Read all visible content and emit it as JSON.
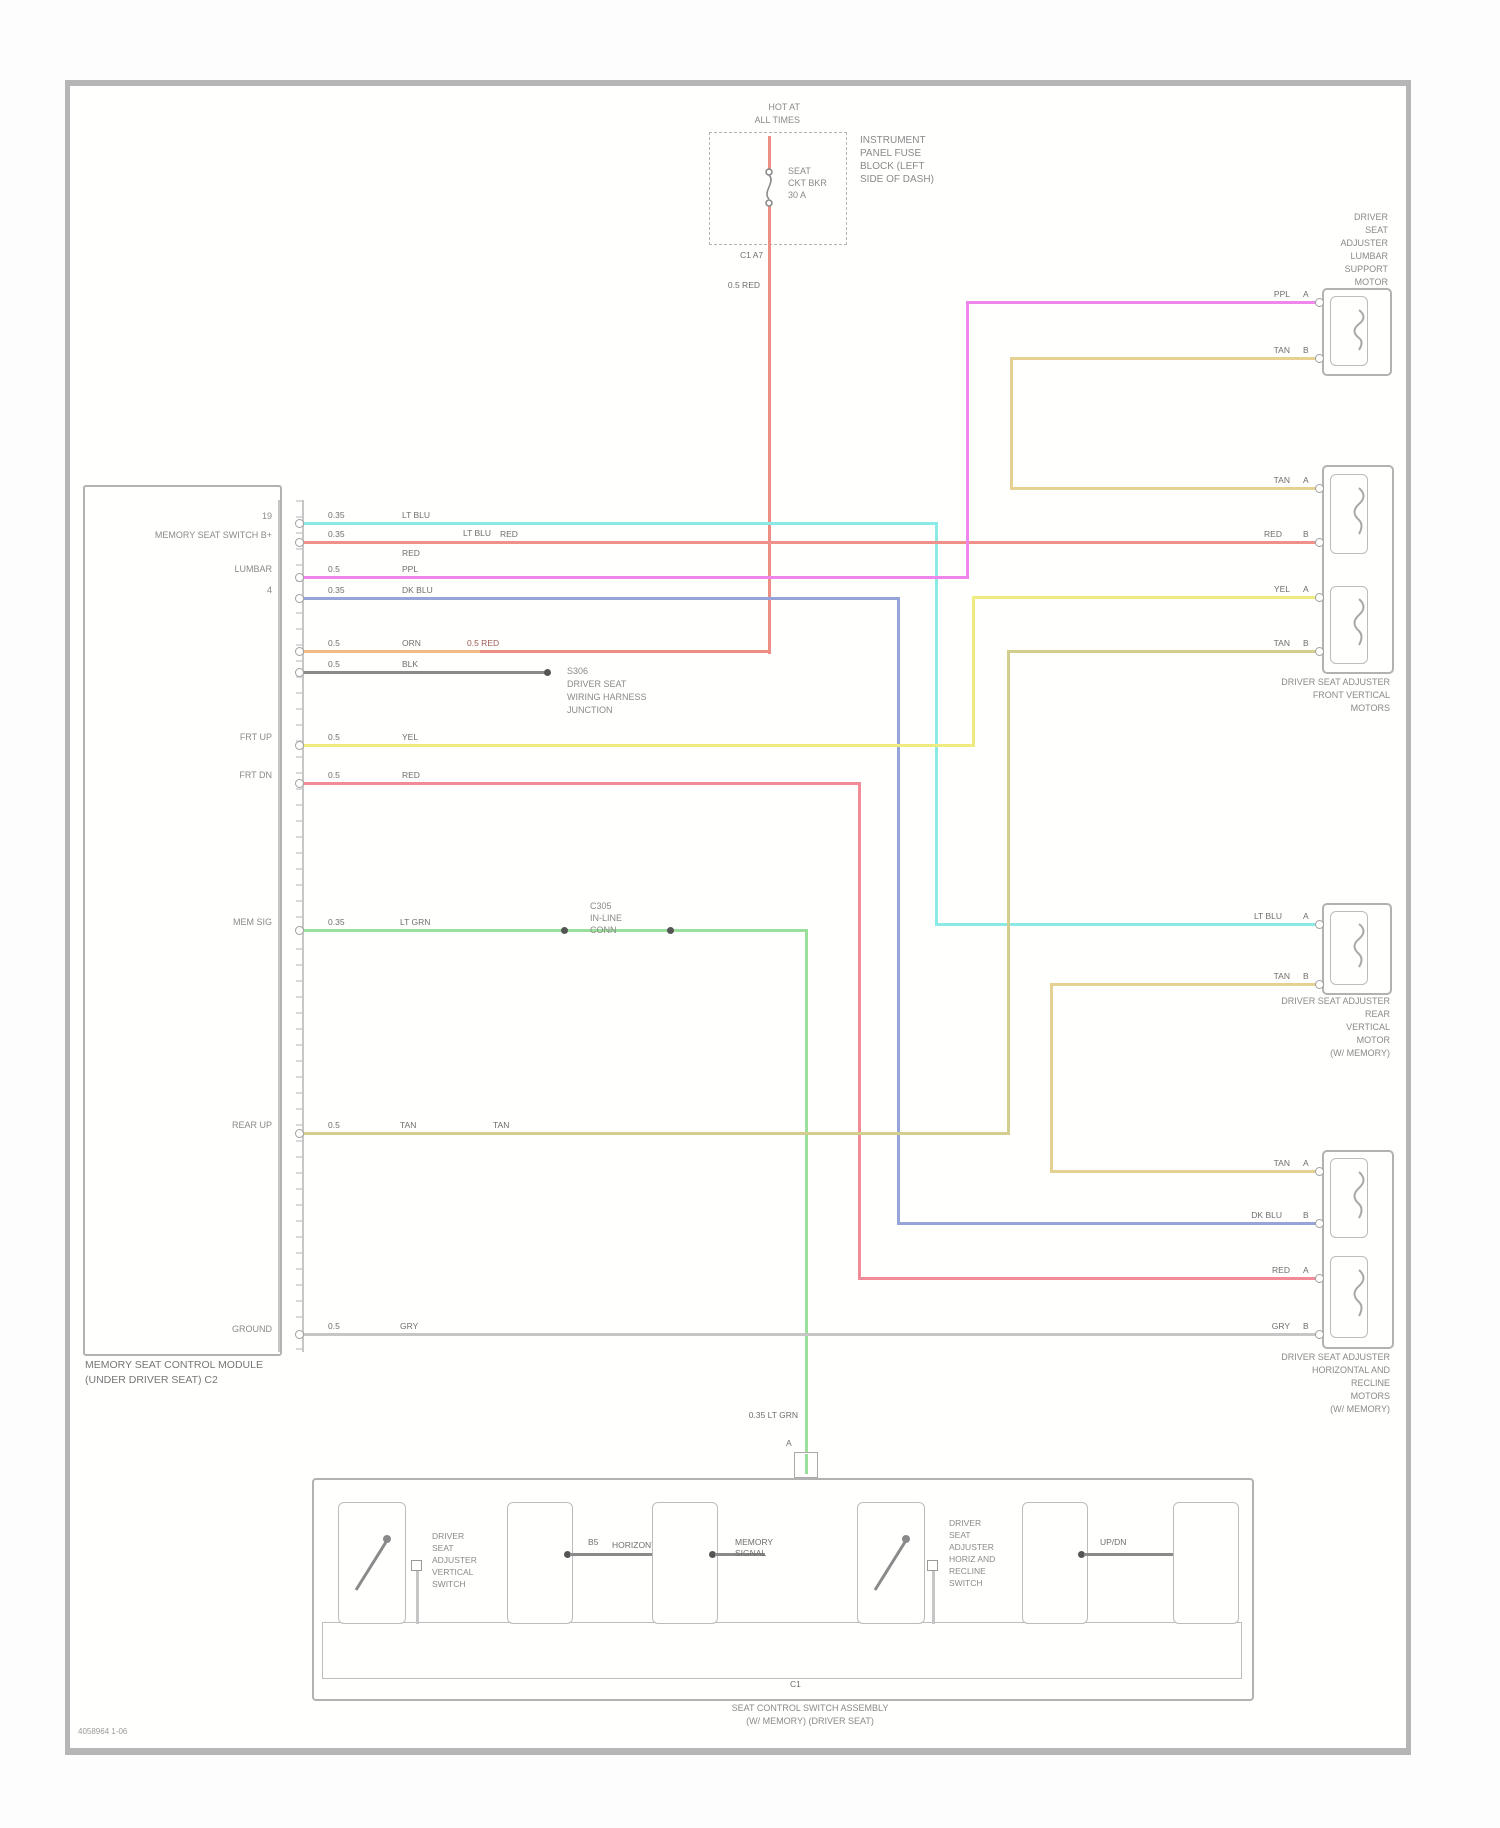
{
  "colors": {
    "cyan": "#8ceae6",
    "salmon": "#ef9189",
    "magenta": "#ef86ec",
    "blue": "#97a4da",
    "orange": "#f2bb86",
    "black": "#8a8a8a",
    "yellow": "#f0eb80",
    "pink": "#f18b97",
    "green": "#9adf9a",
    "olive": "#d3ce8d",
    "tan": "#e5d292",
    "gray": "#c6c6c6",
    "red": "#ee8d84"
  },
  "fuse": {
    "hot1": "HOT AT",
    "hot2": "ALL TIMES",
    "name1": "SEAT",
    "name2": "CKT BKR",
    "name3": "30 A",
    "block1": "INSTRUMENT",
    "block2": "PANEL FUSE",
    "block3": "BLOCK (LEFT",
    "block4": "SIDE OF DASH)",
    "conn": "C1  A7",
    "wire": "0.5 RED"
  },
  "module": {
    "title1": "MEMORY SEAT CONTROL MODULE",
    "title2": "(UNDER DRIVER SEAT) C2",
    "pin19": "19",
    "pin4": "4",
    "fn_b": "MEMORY SEAT SWITCH B+",
    "fn_lumbar": "LUMBAR",
    "fn_frtup": "FRT UP",
    "fn_frtdn": "FRT DN",
    "fn_mem": "MEM SIG",
    "fn_rearup": "REAR UP",
    "fn_gnd": "GROUND"
  },
  "wires": {
    "r1a": "0.35",
    "r1b": "LT BLU",
    "r1c": "LT BLU",
    "r2a": "0.35",
    "r2b": "RED",
    "r2c": "RED",
    "r3a": "0.5",
    "r3b": "PPL",
    "r4a": "0.35",
    "r4b": "DK BLU",
    "r5a": "0.5",
    "r5b": "ORN",
    "r5c": "0.5 RED",
    "r6a": "0.5",
    "r6b": "BLK",
    "r7a": "0.5",
    "r7b": "YEL",
    "r8a": "0.5",
    "r8b": "RED",
    "r9a": "0.35",
    "r9b": "LT GRN",
    "r9drop": "0.35 LT GRN",
    "r10a": "0.5",
    "r10b": "TAN",
    "r10c": "TAN",
    "r11a": "0.5",
    "r11b": "GRY",
    "rt_ppl": "PPL",
    "rt_tan1": "TAN",
    "rt_tan2": "TAN",
    "rt_red1": "RED",
    "rt_yel": "YEL",
    "rt_tan3": "TAN",
    "rt_ltblu": "LT BLU",
    "rt_tan4": "TAN",
    "rt_tan5": "TAN",
    "rt_dkblu": "DK BLU",
    "rt_red2": "RED",
    "rt_gry": "GRY"
  },
  "splice": {
    "l1": "S306",
    "l2": "DRIVER SEAT",
    "l3": "WIRING HARNESS",
    "l4": "JUNCTION"
  },
  "inline": {
    "l1": "C305",
    "l2": "IN-LINE",
    "l3": "CONN",
    "pin": "A"
  },
  "right": {
    "m1_1": "DRIVER",
    "m1_2": "SEAT",
    "m1_3": "ADJUSTER",
    "m1_4": "LUMBAR",
    "m1_5": "SUPPORT",
    "m1_6": "MOTOR",
    "m2_1": "DRIVER SEAT ADJUSTER",
    "m2_2": "FRONT VERTICAL",
    "m2_3": "MOTORS",
    "m3_1": "DRIVER SEAT ADJUSTER",
    "m3_2": "REAR",
    "m3_3": "VERTICAL",
    "m3_4": "MOTOR",
    "m3_5": "(W/ MEMORY)",
    "m4_1": "DRIVER SEAT ADJUSTER",
    "m4_2": "HORIZONTAL AND",
    "m4_3": "RECLINE",
    "m4_4": "MOTORS",
    "m4_5": "(W/ MEMORY)"
  },
  "pins": {
    "a": "A",
    "b": "B"
  },
  "switchbox": {
    "title1": "SEAT CONTROL SWITCH ASSEMBLY",
    "title2": "(W/ MEMORY) (DRIVER SEAT)",
    "ls1": "DRIVER",
    "ls2": "SEAT",
    "ls3": "ADJUSTER",
    "ls4": "VERTICAL",
    "ls5": "SWITCH",
    "rs1": "DRIVER",
    "rs2": "SEAT",
    "rs3": "ADJUSTER",
    "rs4": "HORIZ AND",
    "rs5": "RECLINE",
    "rs6": "SWITCH",
    "lk1": "B5",
    "lk2": "HORIZONTAL",
    "lk3": "MEMORY",
    "lk4": "SIGNAL",
    "lk5": "UP/DN",
    "c1": "C1",
    "pin_a": "A"
  },
  "footer": "4058964   1-06"
}
